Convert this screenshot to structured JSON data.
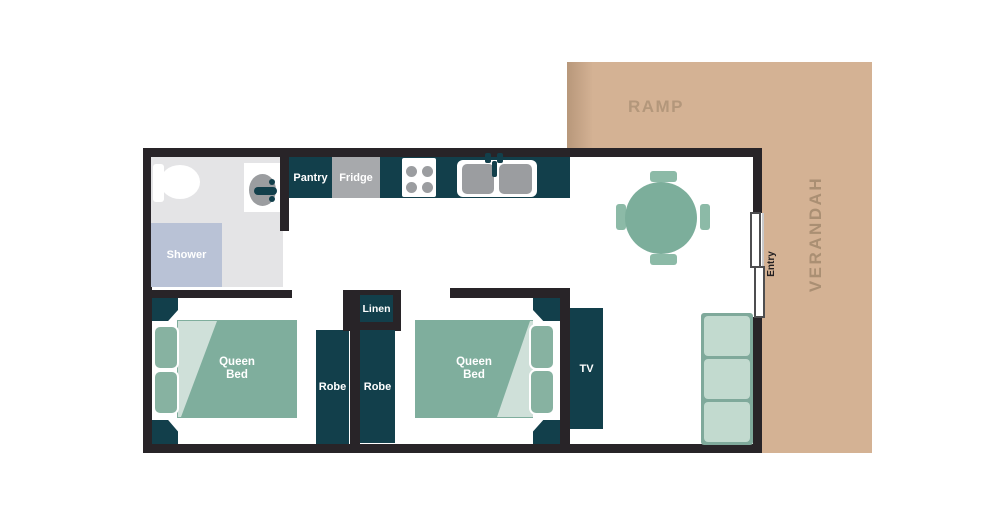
{
  "outdoor": {
    "ramp": "RAMP",
    "verandah": "VERANDAH",
    "entry": "Entry"
  },
  "bathroom": {
    "shower": "Shower"
  },
  "kitchen": {
    "pantry": "Pantry",
    "fridge": "Fridge"
  },
  "bedroom1": {
    "bed": "Queen Bed",
    "robe": "Robe"
  },
  "bedroom2": {
    "bed": "Queen Bed",
    "robe": "Robe"
  },
  "hall": {
    "linen": "Linen"
  },
  "living": {
    "tv": "TV"
  },
  "colors": {
    "wall": "#282428",
    "teal": "#123f4b",
    "tan": "#d4b294",
    "ramp-text": "#b3977b",
    "verandah-text": "#aa8f73",
    "entry-text": "#232022",
    "bed": "#7fae9d",
    "sheet": "#cfe0d9",
    "pillow": "#87b2a1",
    "table": "#7cae9b",
    "chair": "#8cbaa7",
    "couch": "#c2dacf",
    "couch-edge": "#7fa99b",
    "shower": "#b9c2d6",
    "bath-floor": "#e4e4e6",
    "appliance": "#a7a9ac",
    "basin": "#9b9da0",
    "door-border": "#4e4e50"
  }
}
